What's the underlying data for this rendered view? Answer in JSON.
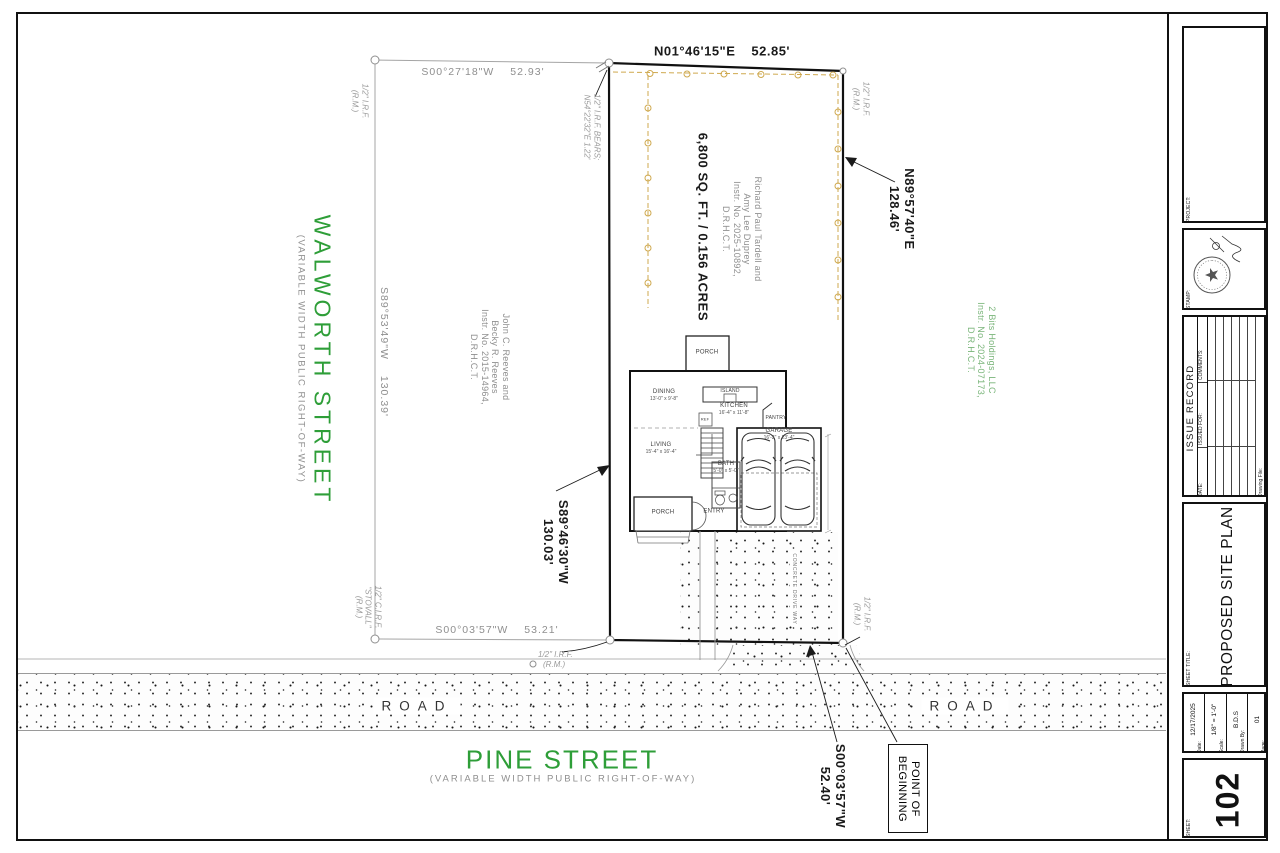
{
  "colors": {
    "street_green": "#2e9e38",
    "owner_green": "#7ab57a",
    "fence_gold": "#cfa94f",
    "ink": "#1a1a1a",
    "gray_text": "#8f8f8f"
  },
  "streets": {
    "walworth": {
      "name": "WALWORTH STREET",
      "row_note": "(VARIABLE WIDTH PUBLIC RIGHT-OF-WAY)"
    },
    "pine": {
      "name": "PINE STREET",
      "row_note": "(VARIABLE WIDTH PUBLIC RIGHT-OF-WAY)"
    },
    "road_label": "ROAD"
  },
  "boundary": {
    "north": {
      "bearing": "N01°46'15\"E",
      "distance": "52.85'"
    },
    "east": {
      "bearing": "N89°57'40\"E",
      "distance": "128.46'"
    },
    "south": {
      "bearing": "S00°03'57\"W",
      "distance": "52.40'"
    },
    "west": {
      "bearing": "S89°46'30\"W",
      "distance": "130.03'"
    },
    "area": "6,800 SQ. FT. / 0.156 ACRES",
    "pob_line1": "POINT OF",
    "pob_line2": "BEGINNING"
  },
  "adjacent": {
    "north_line": {
      "bearing": "S00°27'18\"W",
      "distance": "52.93'"
    },
    "west_line": {
      "bearing": "S89°53'49\"W",
      "distance": "130.39'"
    },
    "south_line": {
      "bearing": "S00°03'57\"W",
      "distance": "53.21'"
    }
  },
  "owners": {
    "west_parcel": [
      "John C. Reeves and",
      "Becky R. Reeves",
      "Instr. No. 2015-14964,",
      "D.R.H.C.T."
    ],
    "subject_parcel": [
      "Richard Paul Tardell and",
      "Amy Lee Duprey",
      "Instr. No. 2025-10892,",
      "D.R.H.C.T."
    ],
    "east_parcel": [
      "2 Bits Holdings, LLC",
      "Instr. No. 2024-07173,",
      "D.R.H.C.T."
    ]
  },
  "monuments": {
    "irf_line1": "1/2\" I.R.F.",
    "rm": "(R.M.)",
    "bears_line1": "1/2\" I.R.F. BEARS;",
    "bears_line2": "N54°22'32\"E 1.22'",
    "cirf_line1": "1/2\" C.I.R.F.",
    "cirf_line2": "\"STOVALL\"",
    "cirf_line3": "(R.M.)"
  },
  "house": {
    "porch_back": "PORCH",
    "porch_front": "PORCH",
    "entry": "ENTRY",
    "island": "ISLAND",
    "ref": "REF",
    "pantry": "PANTRY",
    "dining": {
      "name": "DINING",
      "dims": "13'-0\" x 9'-8\""
    },
    "kitchen": {
      "name": "KITCHEN",
      "dims": "16'-4\" x 11'-8\""
    },
    "living": {
      "name": "LIVING",
      "dims": "15'-4\" x 16'-4\""
    },
    "garage": {
      "name": "GARAGE",
      "dims": "16'-2\" x 23'-4\""
    },
    "bath": {
      "name": "BATH",
      "dims": "5'-0\" x 5'-0\""
    },
    "driveway": "CONCRETE DRIVE WAY"
  },
  "titleblock": {
    "project_label": "PROJECT:",
    "stamp_label": "STAMP:",
    "issue_record": {
      "title": "ISSUE RECORD",
      "col_date": "DATE:",
      "col_issued": "ISSUED FOR:",
      "col_comments": "COMMENTS:",
      "drawing_file": "Drawing File:"
    },
    "sheet_title_label": "SHEET TITLE:",
    "sheet_title": "PROPOSED SITE PLAN",
    "fields": [
      {
        "label": "Date:",
        "value": "12/17/2025"
      },
      {
        "label": "Scale:",
        "value": "1/8\" = 1'-0\""
      },
      {
        "label": "Drawn By:",
        "value": "B.D.S"
      },
      {
        "label": "Page:",
        "value": "01"
      }
    ],
    "sheet_label": "SHEET:",
    "sheet_number": "102"
  }
}
